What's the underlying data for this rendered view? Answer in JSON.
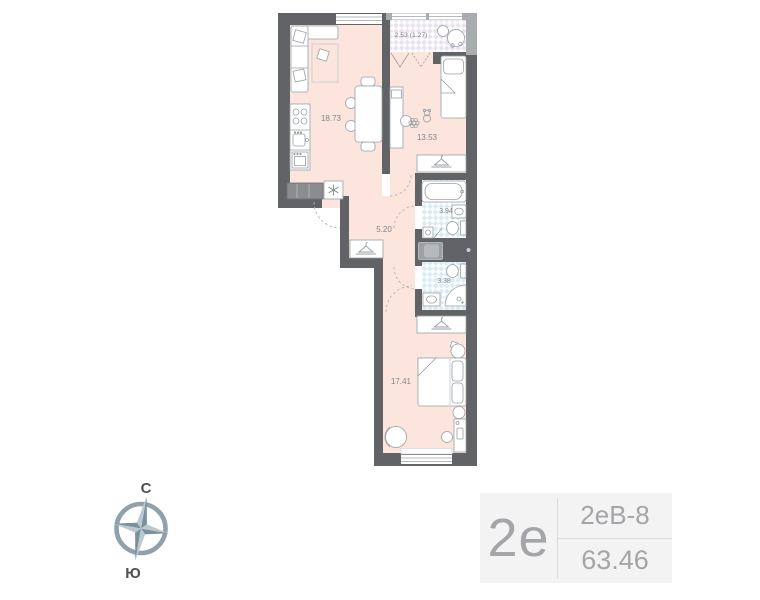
{
  "floor_plan": {
    "rooms": [
      {
        "name": "kitchen-living-room",
        "area": "18.73"
      },
      {
        "name": "child-bedroom",
        "area": "13.53"
      },
      {
        "name": "balcony",
        "area": "2.53 (1.27)"
      },
      {
        "name": "bathroom",
        "area": "3.94"
      },
      {
        "name": "hallway",
        "area": "5.20"
      },
      {
        "name": "shower-room",
        "area": "3.38"
      },
      {
        "name": "bedroom",
        "area": "17.41"
      }
    ],
    "colors": {
      "wall": "#616366",
      "balcony_wall": "#a7acb0",
      "room_fill": "#fce5dc",
      "wet_zone_check": "#d9ecf3",
      "balcony_check": "#e9e2f1",
      "furniture_stroke": "#99a0a5",
      "label_text": "#82868a"
    }
  },
  "compass": {
    "north": "С",
    "south": "Ю"
  },
  "info_card": {
    "layout_type": "2е",
    "plan_code": "2еВ-8",
    "area_total": "63.46"
  }
}
